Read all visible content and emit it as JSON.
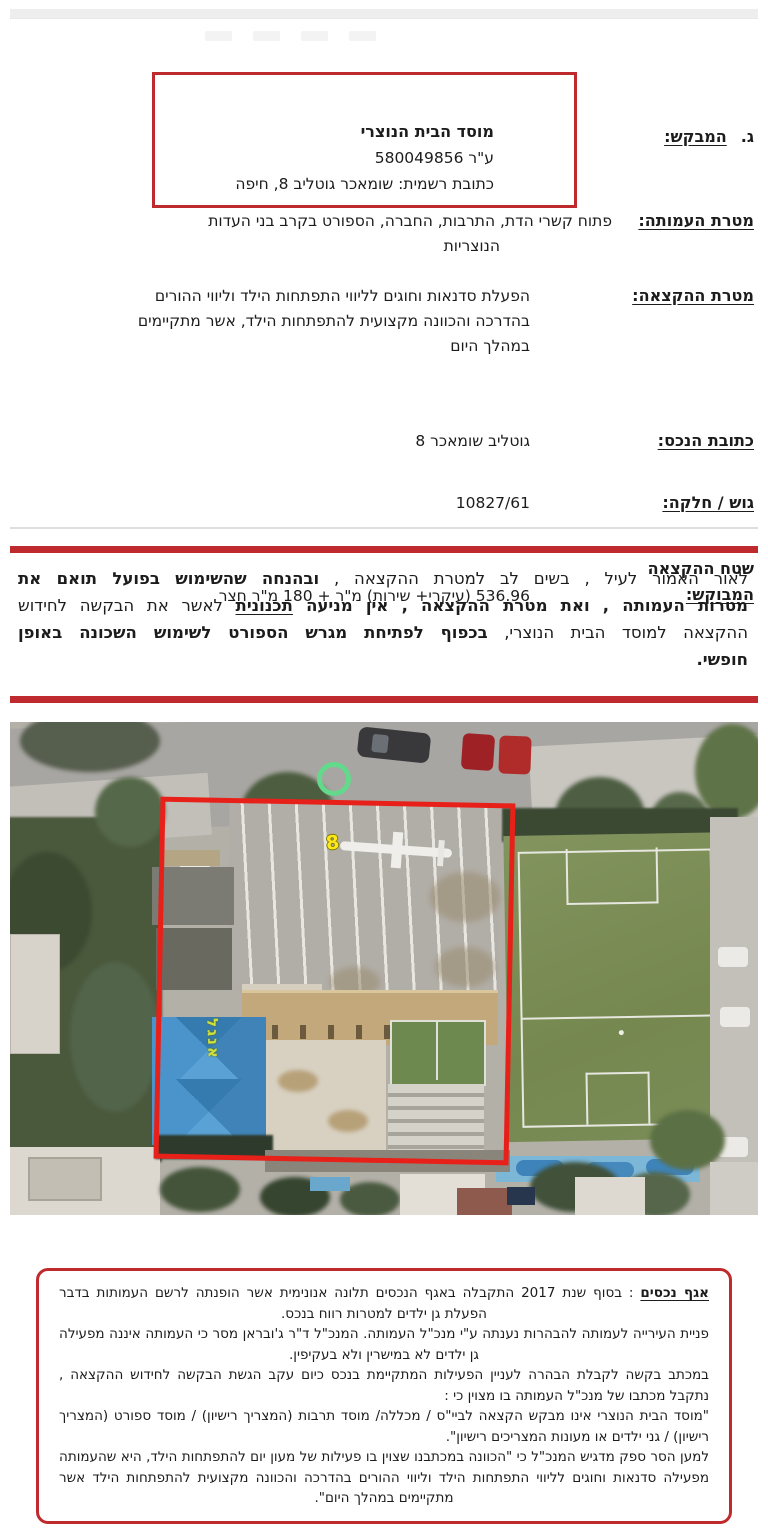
{
  "colors": {
    "accent_red": "#bf2a2e",
    "photo_outline_red": "#e8201a",
    "marker_green": "#63d98b",
    "plot_label_yellow": "#ffe81a",
    "roof_blue": "#4a94cb"
  },
  "applicant_box": {
    "name": "מוסד הבית הנוצרי",
    "registration": "ע\"ר 580049856",
    "official_address": "כתובת רשמית: שומאכר גוטליב 8, חיפה"
  },
  "fields": {
    "applicant": {
      "index": "ג.",
      "label": "המבקש:"
    },
    "assoc_purpose": {
      "label": "מטרת העמותה:",
      "line1": "פתוח קשרי הדת, התרבות, החברה, הספורט בקרב בני העדות",
      "line2": "הנוצריות"
    },
    "alloc_purpose": {
      "label": "מטרת ההקצאה:",
      "line1": "הפעלת סדנאות וחוגים לליווי התפתחות הילד וליווי ההורים",
      "line2": "בהדרכה והכוונה מקצועית להתפתחות הילד, אשר מתקיימים",
      "line3": "במהלך היום"
    },
    "property_address": {
      "label": "כתובת הנכס:",
      "value": "גוטליב שומאכר 8"
    },
    "block_parcel": {
      "label": "גוש / חלקה:",
      "value": "10827/61"
    },
    "area": {
      "label_line1": "שטח ההקצאה",
      "label_line2": "המבוקש:",
      "value": "536.96 (עיקרי+ שירות) מ\"ר + 180 מ\"ר חצר"
    }
  },
  "conclusion": {
    "l1a": "לאור האמור לעיל , בשים לב למטרת ההקצאה , ",
    "l1b": "ובהנחה שהשימוש בפועל תואם את",
    "l2a": "מטרות העמותה , ואת מטרת ההקצאה , אין מניעה ",
    "l2b": "תכנונית",
    "l2c": "  לאשר את הבקשה לחידוש",
    "l3a": "ההקצאה למוסד הבית הנוצרי, ",
    "l3b": "בכפוף לפתיחת מגרש הספורט לשימוש השכונה באופן",
    "l4": "חופשי."
  },
  "aerial": {
    "plot_number": "8",
    "roof_label": "אנגל"
  },
  "assets_box": {
    "title": "אגף נכסים",
    "p1_rest": " : בסוף שנת 2017 התקבלה באגף הנכסים תלונה אנונימית אשר הופנתה לרשם העמותות בדבר הפעלת גן ילדים למטרות רווח בנכס.",
    "p2": "פניית העירייה לעמותה להבהרות נענתה ע\"י מנכ\"ל העמותה. המנכ\"ל ד\"ר ג'ובראן מסר כי העמותה איננה מפעילה גן ילדים לא במישרין ולא בעקיפין.",
    "p3": "במכתב בקשה לקבלת הבהרה לעניין הפעילות המתקיימת בנכס כיום עקב הגשת הבקשה לחידוש ההקצאה , נתקבל מכתבו של מנכ\"ל העמותה בו מצוין כי :",
    "p4": "\"מוסד הבית הנוצרי אינו מבקש הקצאה לביי\"ס / מכללה/ מוסד תרבות (המצריך רישיון) / מוסד ספורט (המצריך רישיון) / גני ילדים או מעונות המצריכים רישיון\".",
    "p5": "למען הסר ספק מדגיש המנכ\"ל כי \"הכוונה במכתבנו שצוין בו פעילות של מעון יום להתפתחות הילד, היא שהעמותה מפעילה סדנאות וחוגים לליווי התפתחות הילד וליווי ההורים בהדרכה והכוונה מקצועית להתפתחות הילד אשר מתקיימים במהלך היום\"."
  }
}
